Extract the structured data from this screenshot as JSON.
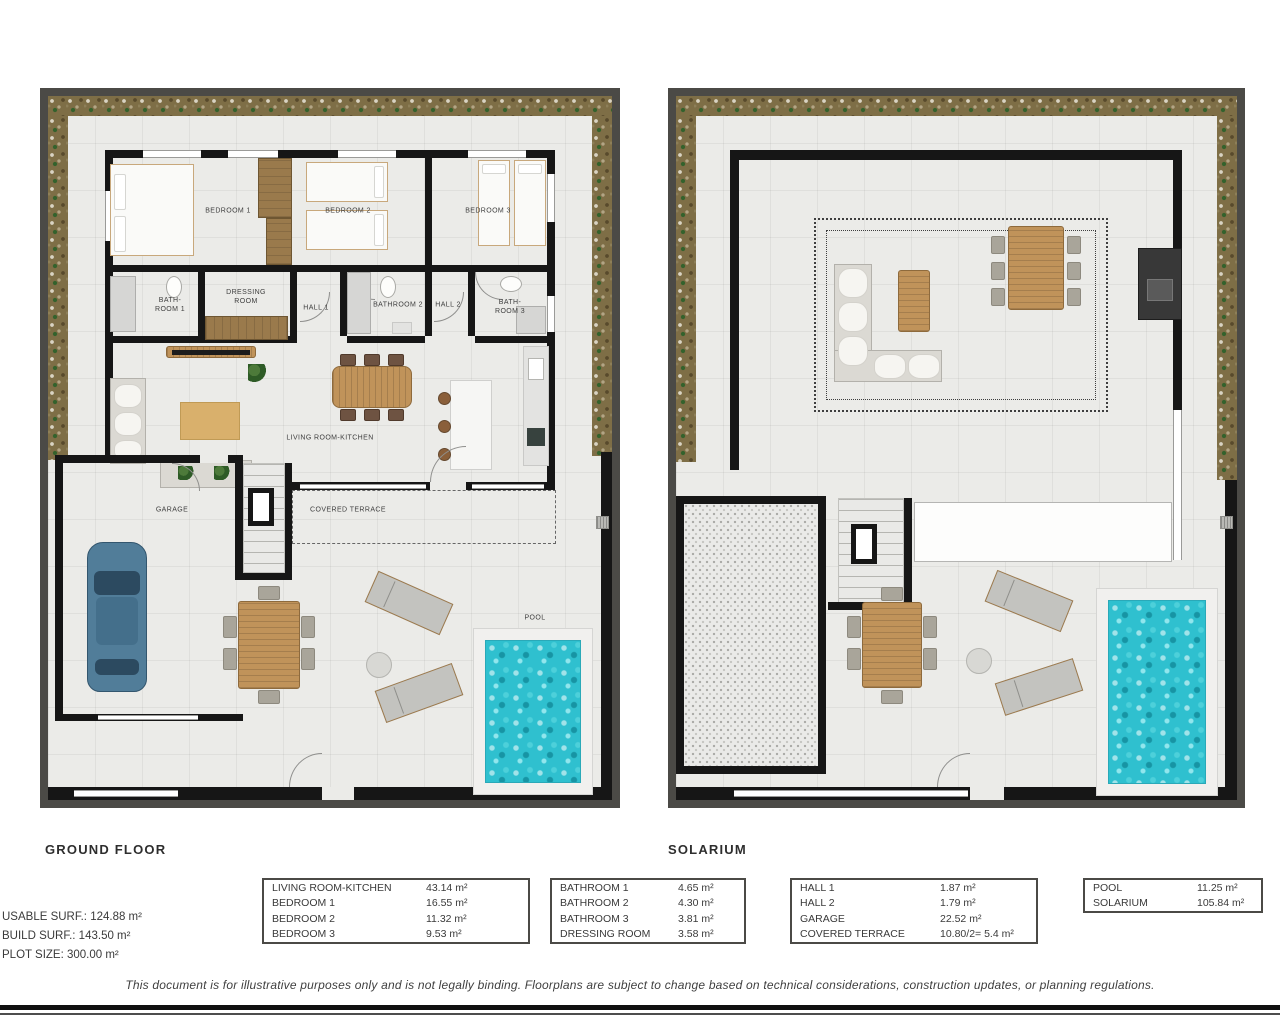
{
  "ground_floor": {
    "title": "GROUND FLOOR",
    "labels": {
      "bedroom1": "BEDROOM 1",
      "bedroom2": "BEDROOM 2",
      "bedroom3": "BEDROOM 3",
      "bathroom1": "BATH-\nROOM 1",
      "dressing_room": "DRESSING\nROOM",
      "hall1": "HALL 1",
      "bathroom2": "BATHROOM 2",
      "hall2": "HALL 2",
      "bathroom3": "BATH-\nROOM 3",
      "living_room": "LIVING ROOM-KITCHEN",
      "garage": "GARAGE",
      "covered_terrace": "COVERED TERRACE",
      "pool": "POOL"
    }
  },
  "solarium": {
    "title": "SOLARIUM"
  },
  "summary": {
    "lines": [
      "USABLE SURF.: 124.88 m²",
      "BUILD SURF.: 143.50 m²",
      "PLOT SIZE: 300.00 m²"
    ]
  },
  "area_tables": [
    {
      "rows": [
        {
          "label": "LIVING ROOM-KITCHEN",
          "value": "43.14 m²"
        },
        {
          "label": "BEDROOM 1",
          "value": "16.55 m²"
        },
        {
          "label": "BEDROOM 2",
          "value": "11.32 m²"
        },
        {
          "label": "BEDROOM 3",
          "value": "9.53 m²"
        }
      ]
    },
    {
      "rows": [
        {
          "label": "BATHROOM 1",
          "value": "4.65 m²"
        },
        {
          "label": "BATHROOM 2",
          "value": "4.30 m²"
        },
        {
          "label": "BATHROOM 3",
          "value": "3.81 m²"
        },
        {
          "label": "DRESSING ROOM",
          "value": "3.58 m²"
        }
      ]
    },
    {
      "rows": [
        {
          "label": "HALL 1",
          "value": "1.87 m²"
        },
        {
          "label": "HALL 2",
          "value": "1.79 m²"
        },
        {
          "label": "GARAGE",
          "value": "22.52 m²"
        },
        {
          "label": "COVERED TERRACE",
          "value": "10.80/2= 5.4 m²"
        }
      ]
    },
    {
      "rows": [
        {
          "label": "POOL",
          "value": "11.25 m²"
        },
        {
          "label": "SOLARIUM",
          "value": "105.84 m²"
        }
      ]
    }
  ],
  "disclaimer": "This document is for illustrative purposes only and is not legally binding. Floorplans are subject to change based on technical considerations, construction updates, or planning regulations.",
  "colors": {
    "wall": "#161616",
    "plot_border": "#4b4a46",
    "floor": "#ebebe8",
    "gravel": "#7e6e46",
    "pool_water": "#2fc0cf",
    "wood": "#c0935a",
    "car": "#517d99"
  }
}
